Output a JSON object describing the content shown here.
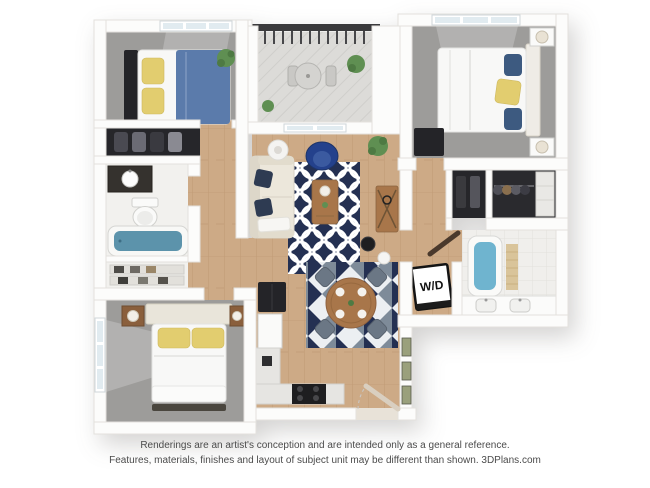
{
  "labels": {
    "washer_dryer": "W/D"
  },
  "footer": {
    "line1": "Renderings are an artist's conception and are intended only as a general reference.",
    "line2": "Features, materials, finishes and layout of subject unit may be different than shown. 3DPlans.com"
  },
  "colors": {
    "wall_stroke": "#e3e1dd",
    "wood": "#cdaa86",
    "wood_grain": "#bf9a74",
    "carpet": "#9d9c9a",
    "tile": "#f0efec",
    "balcony": "#dcdbd8",
    "rug_navy": "#243052",
    "rug_slate": "#7e8b99",
    "bed_blue": "#5b7bab",
    "pillow_yellow": "#e2cd6f",
    "chair_blue": "#24418c",
    "tub_teal": "#5c93ab",
    "tub_blue": "#6fb4cf",
    "dark_furniture": "#242428",
    "wood_furniture": "#a8764a",
    "sofa_cream": "#ece7db",
    "plant_green": "#5f8f52",
    "footer_text": "#4b4b4b"
  }
}
